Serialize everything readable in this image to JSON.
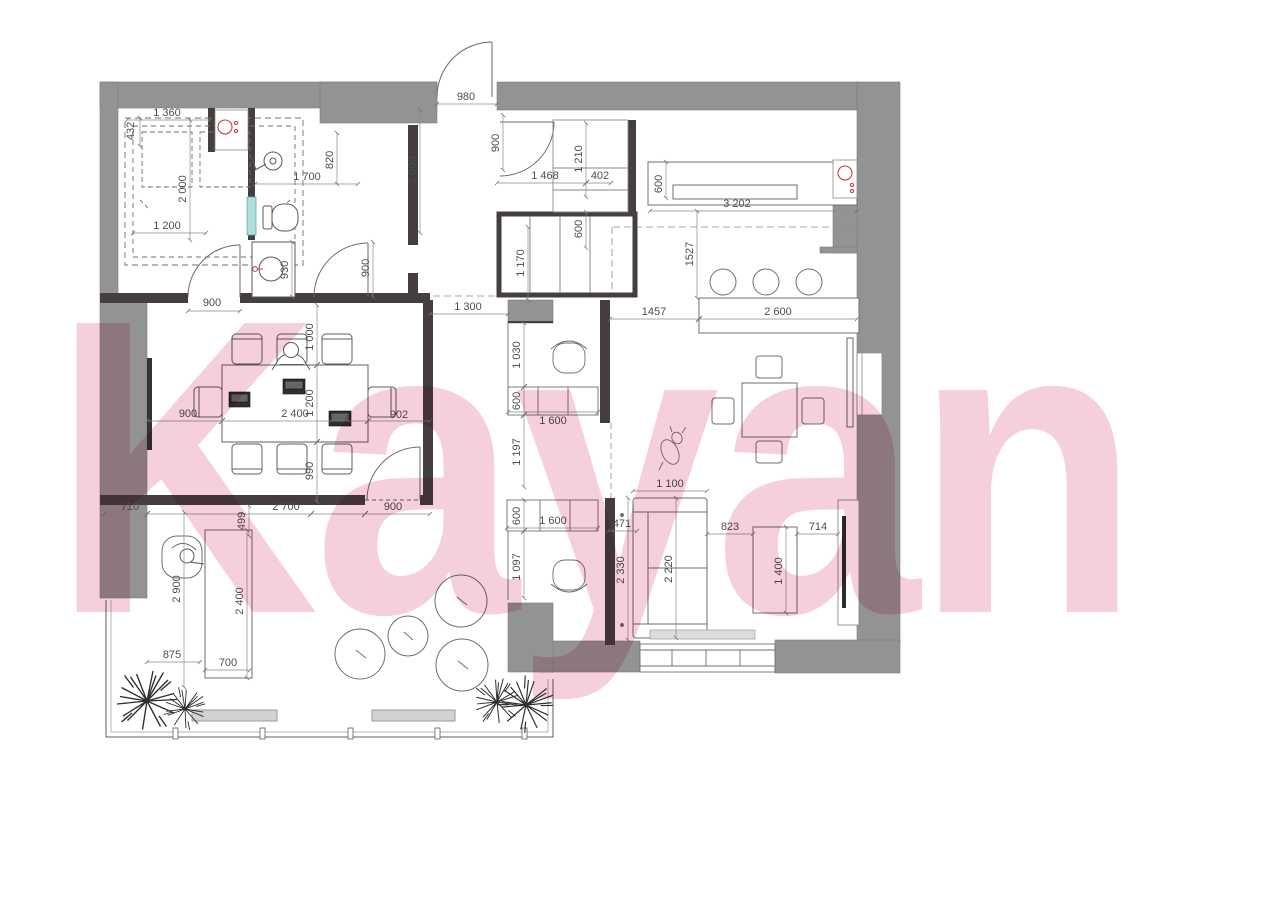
{
  "watermark": {
    "text": "Kayan",
    "color": "#f5cbd7"
  },
  "palette": {
    "wall_gray": "#939393",
    "wall_dark": "#443e40",
    "line_gray": "#707070",
    "dim_text": "#4d4d4d",
    "accent_red": "#c2413b",
    "shower_teal": "#aededa",
    "furniture_light_gray": "#dcdcdc"
  },
  "icons": [
    "washbasin-icon",
    "shower-icon",
    "toilet-icon",
    "kitchen-sink-icon",
    "bar-stool-icon",
    "plant-icon",
    "tv-icon",
    "sofa-icon",
    "armchair-icon",
    "office-chair-icon",
    "laptop-icon",
    "person-figure",
    "dog-figure",
    "pouf-icon",
    "bench-icon",
    "door-swing-icon"
  ],
  "dims": {
    "laundry_width": "1 360",
    "laundry_nook_depth": "432",
    "laundry_height": "2 000",
    "laundry_inner_width": "1 200",
    "shower_width": "1 700",
    "shower_depth": "820",
    "vanity_length": "930",
    "bath_door": "900",
    "entry_door": "980",
    "closet_door": "900",
    "hall_depth": "2 000",
    "closet_upper_width": "1 210",
    "closet_section_a": "1 468",
    "closet_section_b": "402",
    "closet_depth": "600",
    "kitchen_depth": "600",
    "kitchen_length": "3 202",
    "kitchen_island_gap": "1527",
    "hall_width": "1 170",
    "corridor_width": "1 300",
    "island_clearance": "1457",
    "island_length": "2 600",
    "meeting_opening": "900",
    "meeting_offset_top": "1 000",
    "meeting_table_depth": "1 200",
    "meeting_offset_bottom": "990",
    "meeting_left_gap": "900",
    "meeting_table_width": "2 400",
    "meeting_right_gap": "902",
    "meeting_wall_left": "710",
    "meeting_bottom_span": "2 700",
    "meeting_door": "900",
    "desk_offset": "499",
    "ws1_clearance": "1 030",
    "ws1_desk_depth": "600",
    "ws1_desk_width": "1 600",
    "ws_gap": "1 197",
    "ws2_desk_depth": "600",
    "ws2_desk_width": "1 600",
    "ws2_clearance": "1 097",
    "sofa_width": "1 100",
    "partition_depth": "471",
    "partition_length": "2 330",
    "sofa_length": "2 220",
    "sofa_table_gap": "823",
    "coffee_table_length": "1 400",
    "tv_gap": "714",
    "desk_wall_length": "2 900",
    "desk_length": "2 400",
    "desk_gap_a": "875",
    "desk_width": "700"
  }
}
